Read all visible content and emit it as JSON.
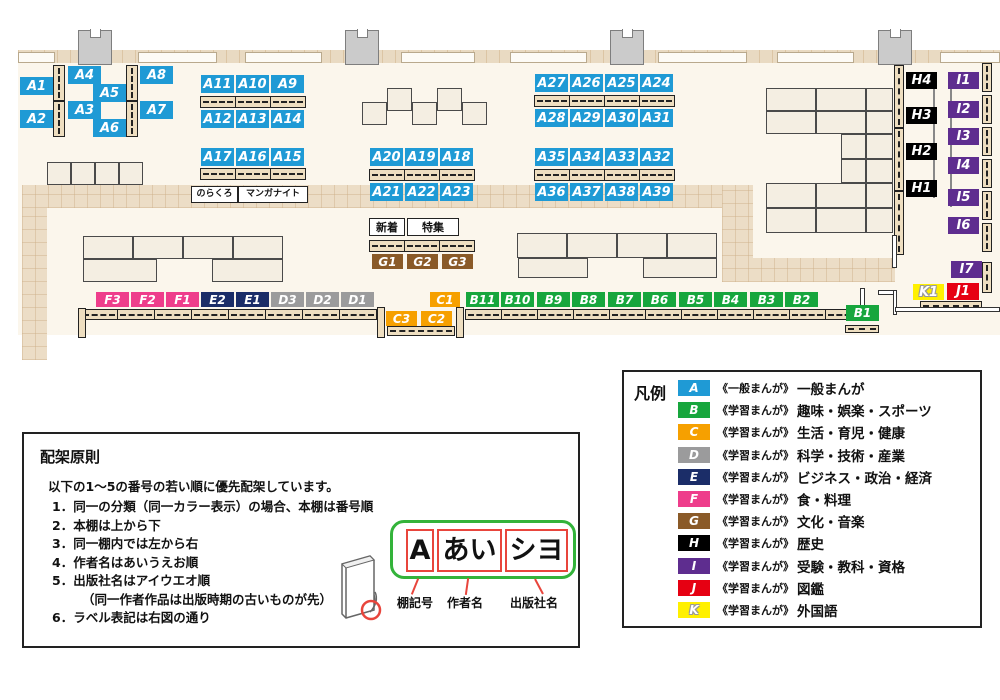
{
  "map": {
    "categories": {
      "A": {
        "color": "#1f9ad5"
      },
      "B": {
        "color": "#17a63d"
      },
      "C": {
        "color": "#f6a000"
      },
      "D": {
        "color": "#9b9b9c"
      },
      "E": {
        "color": "#1b2d68"
      },
      "F": {
        "color": "#ee3d8b"
      },
      "G": {
        "color": "#8a5a28"
      },
      "H": {
        "color": "#000000"
      },
      "I": {
        "color": "#5e2d8f"
      },
      "J": {
        "color": "#e60012"
      },
      "K": {
        "color": "#fff000"
      }
    },
    "shelf_labels": [
      {
        "id": "A1",
        "cat": "A",
        "x": 20,
        "y": 77
      },
      {
        "id": "A2",
        "cat": "A",
        "x": 20,
        "y": 110
      },
      {
        "id": "A4",
        "cat": "A",
        "x": 68,
        "y": 66
      },
      {
        "id": "A5",
        "cat": "A",
        "x": 93,
        "y": 84
      },
      {
        "id": "A3",
        "cat": "A",
        "x": 68,
        "y": 101
      },
      {
        "id": "A6",
        "cat": "A",
        "x": 93,
        "y": 119
      },
      {
        "id": "A8",
        "cat": "A",
        "x": 140,
        "y": 66
      },
      {
        "id": "A7",
        "cat": "A",
        "x": 140,
        "y": 101
      },
      {
        "id": "A11",
        "cat": "A",
        "x": 201,
        "y": 75
      },
      {
        "id": "A10",
        "cat": "A",
        "x": 236,
        "y": 75
      },
      {
        "id": "A9",
        "cat": "A",
        "x": 271,
        "y": 75
      },
      {
        "id": "A12",
        "cat": "A",
        "x": 201,
        "y": 110
      },
      {
        "id": "A13",
        "cat": "A",
        "x": 236,
        "y": 110
      },
      {
        "id": "A14",
        "cat": "A",
        "x": 271,
        "y": 110
      },
      {
        "id": "A17",
        "cat": "A",
        "x": 201,
        "y": 148
      },
      {
        "id": "A16",
        "cat": "A",
        "x": 236,
        "y": 148
      },
      {
        "id": "A15",
        "cat": "A",
        "x": 271,
        "y": 148
      },
      {
        "id": "A20",
        "cat": "A",
        "x": 370,
        "y": 148
      },
      {
        "id": "A19",
        "cat": "A",
        "x": 405,
        "y": 148
      },
      {
        "id": "A18",
        "cat": "A",
        "x": 440,
        "y": 148
      },
      {
        "id": "A21",
        "cat": "A",
        "x": 370,
        "y": 183
      },
      {
        "id": "A22",
        "cat": "A",
        "x": 405,
        "y": 183
      },
      {
        "id": "A23",
        "cat": "A",
        "x": 440,
        "y": 183
      },
      {
        "id": "A27",
        "cat": "A",
        "x": 535,
        "y": 74
      },
      {
        "id": "A26",
        "cat": "A",
        "x": 570,
        "y": 74
      },
      {
        "id": "A25",
        "cat": "A",
        "x": 605,
        "y": 74
      },
      {
        "id": "A24",
        "cat": "A",
        "x": 640,
        "y": 74
      },
      {
        "id": "A28",
        "cat": "A",
        "x": 535,
        "y": 109
      },
      {
        "id": "A29",
        "cat": "A",
        "x": 570,
        "y": 109
      },
      {
        "id": "A30",
        "cat": "A",
        "x": 605,
        "y": 109
      },
      {
        "id": "A31",
        "cat": "A",
        "x": 640,
        "y": 109
      },
      {
        "id": "A35",
        "cat": "A",
        "x": 535,
        "y": 148
      },
      {
        "id": "A34",
        "cat": "A",
        "x": 570,
        "y": 148
      },
      {
        "id": "A33",
        "cat": "A",
        "x": 605,
        "y": 148
      },
      {
        "id": "A32",
        "cat": "A",
        "x": 640,
        "y": 148
      },
      {
        "id": "A36",
        "cat": "A",
        "x": 535,
        "y": 183
      },
      {
        "id": "A37",
        "cat": "A",
        "x": 570,
        "y": 183
      },
      {
        "id": "A38",
        "cat": "A",
        "x": 605,
        "y": 183
      },
      {
        "id": "A39",
        "cat": "A",
        "x": 640,
        "y": 183
      },
      {
        "id": "G1",
        "cat": "G",
        "x": 372,
        "y": 254,
        "w": 31,
        "h": 15,
        "fs": 12
      },
      {
        "id": "G2",
        "cat": "G",
        "x": 407,
        "y": 254,
        "w": 31,
        "h": 15,
        "fs": 12
      },
      {
        "id": "G3",
        "cat": "G",
        "x": 442,
        "y": 254,
        "w": 31,
        "h": 15,
        "fs": 12
      },
      {
        "id": "F3",
        "cat": "F",
        "x": 96,
        "y": 292,
        "w": 33,
        "h": 15,
        "fs": 12
      },
      {
        "id": "F2",
        "cat": "F",
        "x": 131,
        "y": 292,
        "w": 33,
        "h": 15,
        "fs": 12
      },
      {
        "id": "F1",
        "cat": "F",
        "x": 166,
        "y": 292,
        "w": 33,
        "h": 15,
        "fs": 12
      },
      {
        "id": "E2",
        "cat": "E",
        "x": 201,
        "y": 292,
        "w": 33,
        "h": 15,
        "fs": 12
      },
      {
        "id": "E1",
        "cat": "E",
        "x": 236,
        "y": 292,
        "w": 33,
        "h": 15,
        "fs": 12
      },
      {
        "id": "D3",
        "cat": "D",
        "x": 271,
        "y": 292,
        "w": 33,
        "h": 15,
        "fs": 12
      },
      {
        "id": "D2",
        "cat": "D",
        "x": 306,
        "y": 292,
        "w": 33,
        "h": 15,
        "fs": 12
      },
      {
        "id": "D1",
        "cat": "D",
        "x": 341,
        "y": 292,
        "w": 33,
        "h": 15,
        "fs": 12
      },
      {
        "id": "C1",
        "cat": "C",
        "x": 430,
        "y": 292,
        "w": 30,
        "h": 15,
        "fs": 12
      },
      {
        "id": "C3",
        "cat": "C",
        "x": 386,
        "y": 311,
        "w": 31,
        "h": 15,
        "fs": 12
      },
      {
        "id": "C2",
        "cat": "C",
        "x": 421,
        "y": 311,
        "w": 31,
        "h": 15,
        "fs": 12
      },
      {
        "id": "B11",
        "cat": "B",
        "x": 466,
        "y": 292,
        "w": 33,
        "h": 15,
        "fs": 12
      },
      {
        "id": "B10",
        "cat": "B",
        "x": 501,
        "y": 292,
        "w": 33,
        "h": 15,
        "fs": 12
      },
      {
        "id": "B9",
        "cat": "B",
        "x": 537,
        "y": 292,
        "w": 33,
        "h": 15,
        "fs": 12
      },
      {
        "id": "B8",
        "cat": "B",
        "x": 572,
        "y": 292,
        "w": 33,
        "h": 15,
        "fs": 12
      },
      {
        "id": "B7",
        "cat": "B",
        "x": 608,
        "y": 292,
        "w": 33,
        "h": 15,
        "fs": 12
      },
      {
        "id": "B6",
        "cat": "B",
        "x": 643,
        "y": 292,
        "w": 33,
        "h": 15,
        "fs": 12
      },
      {
        "id": "B5",
        "cat": "B",
        "x": 679,
        "y": 292,
        "w": 33,
        "h": 15,
        "fs": 12
      },
      {
        "id": "B4",
        "cat": "B",
        "x": 714,
        "y": 292,
        "w": 33,
        "h": 15,
        "fs": 12
      },
      {
        "id": "B3",
        "cat": "B",
        "x": 750,
        "y": 292,
        "w": 33,
        "h": 15,
        "fs": 12
      },
      {
        "id": "B2",
        "cat": "B",
        "x": 785,
        "y": 292,
        "w": 33,
        "h": 15,
        "fs": 12
      },
      {
        "id": "B1",
        "cat": "B",
        "x": 846,
        "y": 305,
        "w": 33,
        "h": 16,
        "fs": 12
      },
      {
        "id": "H4",
        "cat": "H",
        "x": 906,
        "y": 72,
        "w": 31,
        "h": 17
      },
      {
        "id": "H3",
        "cat": "H",
        "x": 906,
        "y": 107,
        "w": 31,
        "h": 17
      },
      {
        "id": "H2",
        "cat": "H",
        "x": 906,
        "y": 143,
        "w": 31,
        "h": 17
      },
      {
        "id": "H1",
        "cat": "H",
        "x": 906,
        "y": 180,
        "w": 31,
        "h": 17
      },
      {
        "id": "I1",
        "cat": "I",
        "x": 948,
        "y": 72,
        "w": 31,
        "h": 17
      },
      {
        "id": "I2",
        "cat": "I",
        "x": 948,
        "y": 101,
        "w": 31,
        "h": 17
      },
      {
        "id": "I3",
        "cat": "I",
        "x": 948,
        "y": 128,
        "w": 31,
        "h": 17
      },
      {
        "id": "I4",
        "cat": "I",
        "x": 948,
        "y": 157,
        "w": 31,
        "h": 17
      },
      {
        "id": "I5",
        "cat": "I",
        "x": 948,
        "y": 189,
        "w": 31,
        "h": 17
      },
      {
        "id": "I6",
        "cat": "I",
        "x": 948,
        "y": 217,
        "w": 31,
        "h": 17
      },
      {
        "id": "I7",
        "cat": "I",
        "x": 951,
        "y": 261,
        "w": 31,
        "h": 17
      },
      {
        "id": "K1",
        "cat": "K",
        "x": 913,
        "y": 284,
        "w": 31,
        "h": 16
      },
      {
        "id": "J1",
        "cat": "J",
        "x": 947,
        "y": 283,
        "w": 32,
        "h": 17
      }
    ],
    "annotations": [
      {
        "text": "のらくろ",
        "x": 191,
        "y": 186,
        "w": 45,
        "h": 15,
        "fs": 9
      },
      {
        "text": "マンガナイト",
        "x": 238,
        "y": 186,
        "w": 68,
        "h": 15,
        "fs": 9
      },
      {
        "text": "新着",
        "x": 369,
        "y": 218,
        "w": 34,
        "h": 16,
        "fs": 11
      },
      {
        "text": "特集",
        "x": 407,
        "y": 218,
        "w": 50,
        "h": 16,
        "fs": 11
      }
    ]
  },
  "legend": {
    "title": "凡例",
    "items": [
      {
        "code": "A",
        "color": "#1f9ad5",
        "type": "《一般まんが》",
        "label": "一般まんが"
      },
      {
        "code": "B",
        "color": "#17a63d",
        "type": "《学習まんが》",
        "label": "趣味・娯楽・スポーツ"
      },
      {
        "code": "C",
        "color": "#f6a000",
        "type": "《学習まんが》",
        "label": "生活・育児・健康"
      },
      {
        "code": "D",
        "color": "#9b9b9c",
        "type": "《学習まんが》",
        "label": "科学・技術・産業"
      },
      {
        "code": "E",
        "color": "#1b2d68",
        "type": "《学習まんが》",
        "label": "ビジネス・政治・経済"
      },
      {
        "code": "F",
        "color": "#ee3d8b",
        "type": "《学習まんが》",
        "label": "食・料理"
      },
      {
        "code": "G",
        "color": "#8a5a28",
        "type": "《学習まんが》",
        "label": "文化・音楽"
      },
      {
        "code": "H",
        "color": "#000000",
        "type": "《学習まんが》",
        "label": "歴史"
      },
      {
        "code": "I",
        "color": "#5e2d8f",
        "type": "《学習まんが》",
        "label": "受験・教科・資格"
      },
      {
        "code": "J",
        "color": "#e60012",
        "type": "《学習まんが》",
        "label": "図鑑"
      },
      {
        "code": "K",
        "color": "#fff000",
        "type": "《学習まんが》",
        "label": "外国語"
      }
    ]
  },
  "principles": {
    "title": "配架原則",
    "intro": "以下の1～5の番号の若い順に優先配架しています。",
    "items": [
      {
        "text": "1．同一の分類（同一カラー表示）の場合、本棚は番号順",
        "indent": false
      },
      {
        "text": "2．本棚は上から下",
        "indent": false
      },
      {
        "text": "3．同一棚内では左から右",
        "indent": false
      },
      {
        "text": "4．作者名はあいうえお順",
        "indent": false
      },
      {
        "text": "5．出版社名はアイウエオ順",
        "indent": false
      },
      {
        "text": "（同一作者作品は出版時期の古いものが先）",
        "indent": true
      },
      {
        "text": "6．ラベル表記は右図の通り",
        "indent": false
      }
    ],
    "diagram": {
      "segments": [
        {
          "text": "A",
          "caption": "棚記号"
        },
        {
          "text": "あい",
          "caption": "作者名"
        },
        {
          "text": "シヨ",
          "caption": "出版社名"
        }
      ]
    }
  }
}
